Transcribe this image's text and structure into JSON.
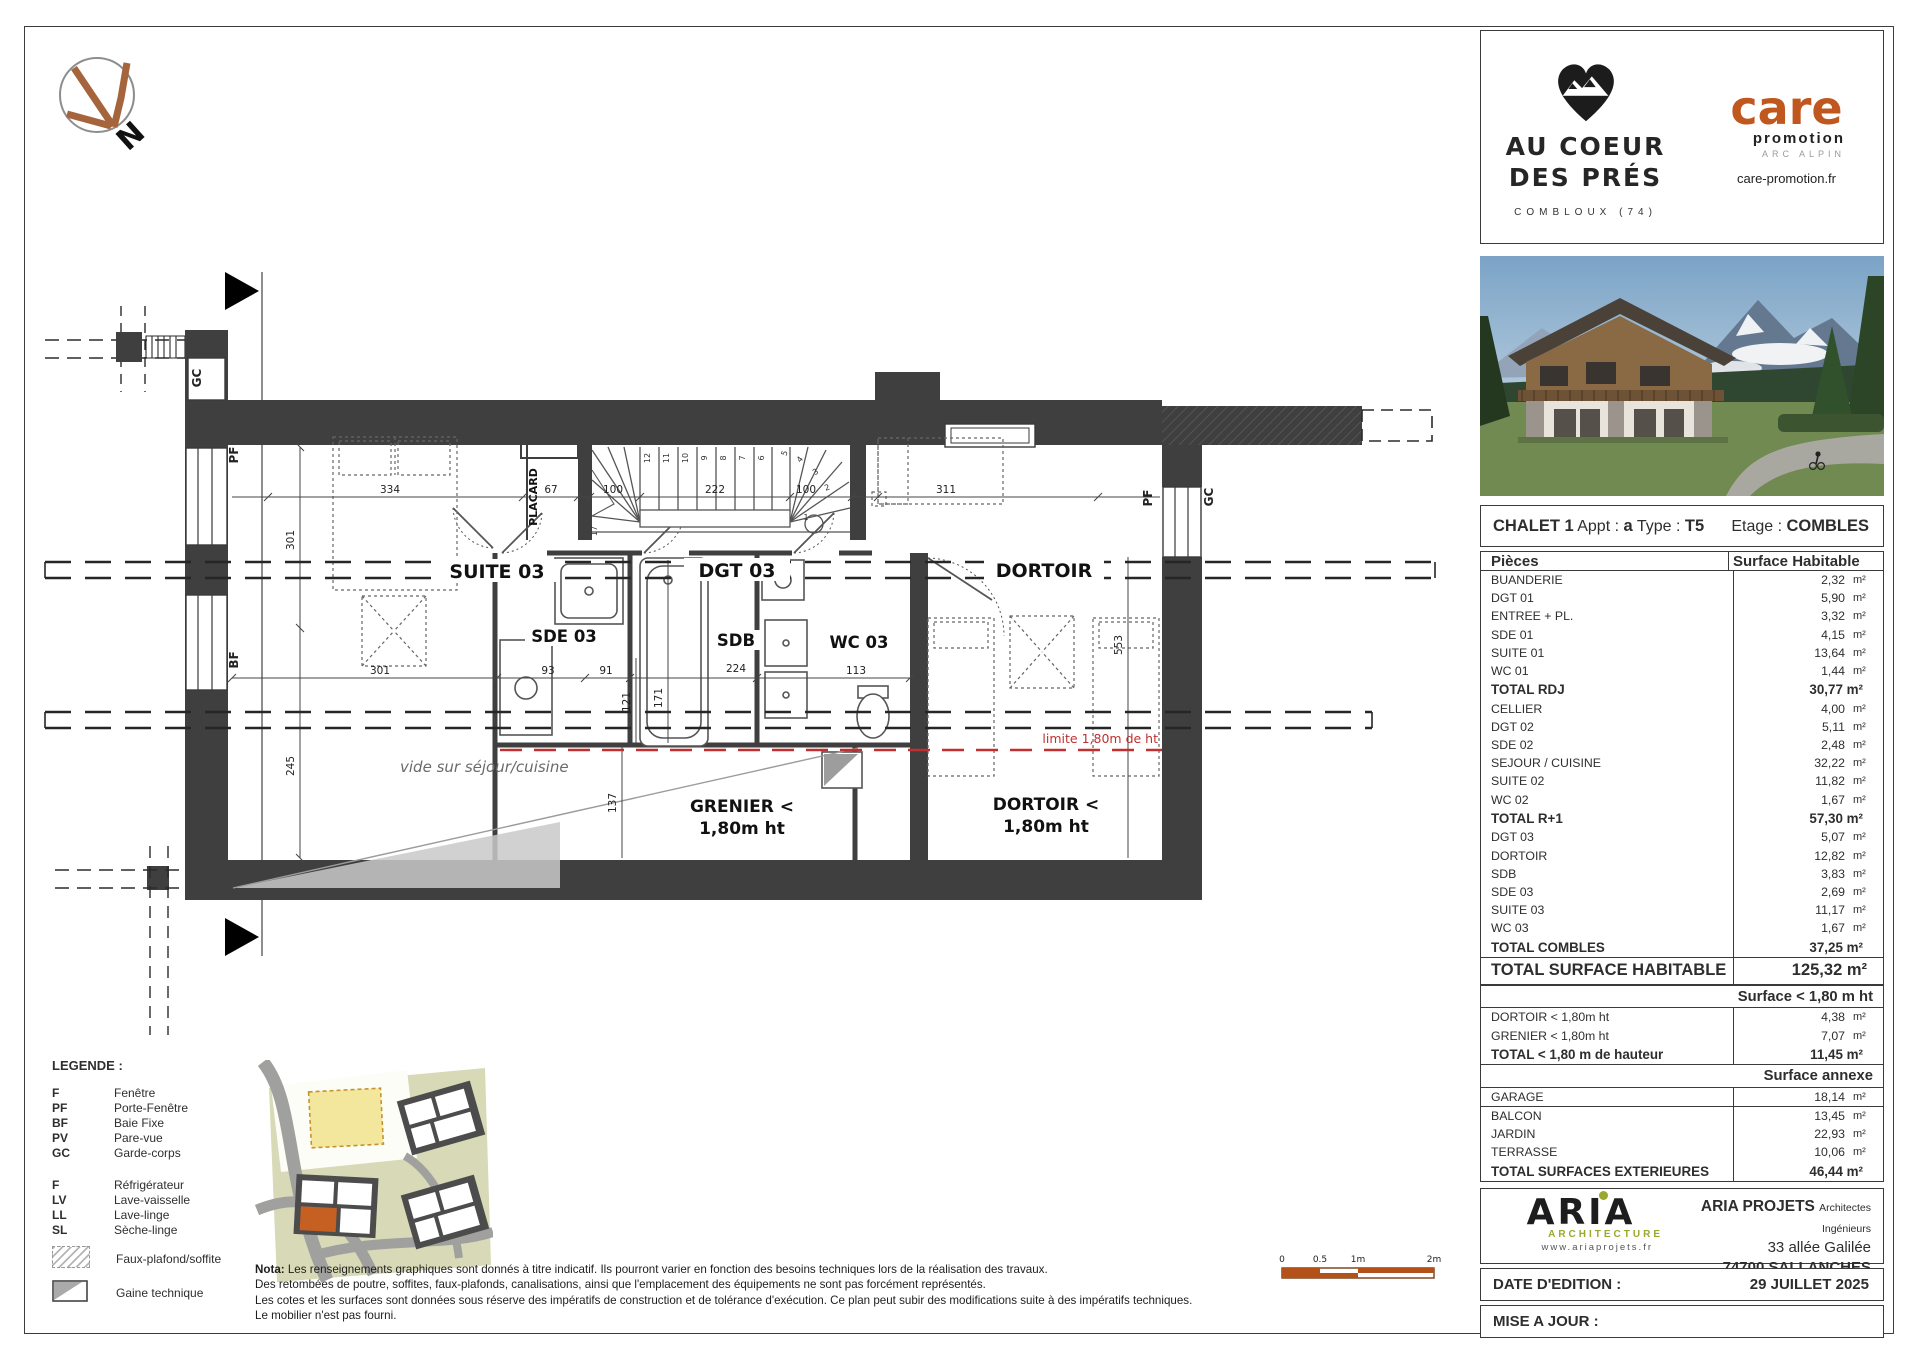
{
  "colors": {
    "accent_orange": "#b5521c",
    "aria_green": "#9aa82e",
    "wall": "#3f3f3f",
    "limit_red": "#c03030"
  },
  "north_label": "N",
  "branding": {
    "project": {
      "line1": "AU COEUR",
      "line2": "DES PRÉS",
      "location": "COMBLOUX (74)"
    },
    "promoter": {
      "name": "care",
      "sub": "promotion",
      "region": "ARC ALPIN",
      "url": "care-promotion.fr"
    }
  },
  "plan": {
    "room_labels": {
      "suite03": "SUITE 03",
      "dgt03": "DGT 03",
      "dortoir": "DORTOIR",
      "sde03": "SDE 03",
      "sdb": "SDB",
      "wc03": "WC 03",
      "placard": "PLACARD"
    },
    "zone_labels": {
      "grenier_l1": "GRENIER <",
      "grenier_l2": "1,80m ht",
      "dortoir_l1": "DORTOIR <",
      "dortoir_l2": "1,80m ht",
      "vide": "vide sur séjour/cuisine",
      "limite": "limite 1,80m de ht"
    },
    "window_labels": {
      "gc_left": "GC",
      "pf_left": "PF",
      "bf_left": "BF",
      "pf_right": "PF",
      "gc_right": "GC"
    },
    "dims": {
      "d334": "334",
      "d67": "67",
      "d100a": "100",
      "d222": "222",
      "d100b": "100",
      "d311": "311",
      "d301v": "301",
      "d245": "245",
      "d301h": "301",
      "d93": "93",
      "d91": "91",
      "d224": "224",
      "d113": "113",
      "d121": "121",
      "d171": "171",
      "d137": "137",
      "d553": "553"
    },
    "stair_numbers": [
      "1",
      "2",
      "3",
      "4",
      "5",
      "6",
      "7",
      "8",
      "9",
      "10",
      "11",
      "12",
      "17"
    ]
  },
  "legend": {
    "title": "LEGENDE :",
    "abbreviations": [
      {
        "abbr": "F",
        "label": "Fenêtre"
      },
      {
        "abbr": "PF",
        "label": "Porte-Fenêtre"
      },
      {
        "abbr": "BF",
        "label": "Baie Fixe"
      },
      {
        "abbr": "PV",
        "label": "Pare-vue"
      },
      {
        "abbr": "GC",
        "label": "Garde-corps"
      }
    ],
    "appliances": [
      {
        "abbr": "F",
        "label": "Réfrigérateur"
      },
      {
        "abbr": "LV",
        "label": "Lave-vaisselle"
      },
      {
        "abbr": "LL",
        "label": "Lave-linge"
      },
      {
        "abbr": "SL",
        "label": "Sèche-linge"
      }
    ],
    "symbols": [
      {
        "label": "Faux-plafond/soffite"
      },
      {
        "label": "Gaine technique"
      }
    ]
  },
  "nota": {
    "prefix": "Nota:",
    "lines": [
      "Les renseignements graphiques sont donnés à titre indicatif. Ils pourront varier en fonction des besoins techniques lors de la réalisation des travaux.",
      "Des retombées de poutre, soffites, faux-plafonds, canalisations, ainsi que l'emplacement des équipements ne sont pas forcément représentés.",
      "Les cotes et les surfaces sont données sous réserve des impératifs de construction et de tolérance d'exécution. Ce plan peut subir des modifications suite à des impératifs techniques.",
      "Le mobilier n'est pas fourni."
    ]
  },
  "scalebar": {
    "ticks": [
      "0",
      "0.5",
      "1m",
      "2m"
    ]
  },
  "title_block": {
    "header": {
      "chalet": "CHALET 1",
      "appt_label": "Appt :",
      "appt_value": "a",
      "type_label": "Type :",
      "type_value": "T5",
      "etage_label": "Etage :",
      "etage_value": "COMBLES"
    },
    "columns": {
      "piece": "Pièces",
      "surface": "Surface Habitable"
    },
    "rows": [
      {
        "cls": "row",
        "label": "BUANDERIE",
        "num": "2,32",
        "unit": "m²"
      },
      {
        "cls": "row",
        "label": "DGT 01",
        "num": "5,90",
        "unit": "m²"
      },
      {
        "cls": "row",
        "label": "ENTREE + PL.",
        "num": "3,32",
        "unit": "m²"
      },
      {
        "cls": "row",
        "label": "SDE 01",
        "num": "4,15",
        "unit": "m²"
      },
      {
        "cls": "row",
        "label": "SUITE 01",
        "num": "13,64",
        "unit": "m²"
      },
      {
        "cls": "row",
        "label": "WC 01",
        "num": "1,44",
        "unit": "m²"
      },
      {
        "cls": "total",
        "label": "TOTAL RDJ",
        "num": "30,77 m²"
      },
      {
        "cls": "row",
        "label": "CELLIER",
        "num": "4,00",
        "unit": "m²"
      },
      {
        "cls": "row",
        "label": "DGT 02",
        "num": "5,11",
        "unit": "m²"
      },
      {
        "cls": "row",
        "label": "SDE 02",
        "num": "2,48",
        "unit": "m²"
      },
      {
        "cls": "row",
        "label": "SEJOUR / CUISINE",
        "num": "32,22",
        "unit": "m²"
      },
      {
        "cls": "row",
        "label": "SUITE 02",
        "num": "11,82",
        "unit": "m²"
      },
      {
        "cls": "row",
        "label": "WC 02",
        "num": "1,67",
        "unit": "m²"
      },
      {
        "cls": "total",
        "label": "TOTAL R+1",
        "num": "57,30 m²"
      },
      {
        "cls": "row",
        "label": "DGT 03",
        "num": "5,07",
        "unit": "m²"
      },
      {
        "cls": "row",
        "label": "DORTOIR",
        "num": "12,82",
        "unit": "m²"
      },
      {
        "cls": "row",
        "label": "SDB",
        "num": "3,83",
        "unit": "m²"
      },
      {
        "cls": "row",
        "label": "SDE 03",
        "num": "2,69",
        "unit": "m²"
      },
      {
        "cls": "row",
        "label": "SUITE 03",
        "num": "11,17",
        "unit": "m²"
      },
      {
        "cls": "row",
        "label": "WC 03",
        "num": "1,67",
        "unit": "m²"
      },
      {
        "cls": "total",
        "label": "TOTAL COMBLES",
        "num": "37,25 m²"
      },
      {
        "cls": "grand",
        "label": "TOTAL SURFACE HABITABLE",
        "num": "125,32 m²"
      },
      {
        "cls": "section",
        "label": "Surface < 1,80 m ht"
      },
      {
        "cls": "row",
        "label": "DORTOIR < 1,80m ht",
        "num": "4,38",
        "unit": "m²"
      },
      {
        "cls": "row",
        "label": "GRENIER < 1,80m ht",
        "num": "7,07",
        "unit": "m²"
      },
      {
        "cls": "total",
        "label": "TOTAL < 1,80 m de hauteur",
        "num": "11,45 m²"
      },
      {
        "cls": "section",
        "label": "Surface annexe"
      },
      {
        "cls": "row bb",
        "label": "GARAGE",
        "num": "18,14",
        "unit": "m²"
      },
      {
        "cls": "row",
        "label": "BALCON",
        "num": "13,45",
        "unit": "m²"
      },
      {
        "cls": "row",
        "label": "JARDIN",
        "num": "22,93",
        "unit": "m²"
      },
      {
        "cls": "row",
        "label": "TERRASSE",
        "num": "10,06",
        "unit": "m²"
      },
      {
        "cls": "total",
        "label": "TOTAL SURFACES EXTERIEURES",
        "num": "46,44 m²"
      }
    ]
  },
  "architect": {
    "logo_text": "ARIA",
    "logo_sub": "ARCHITECTURE",
    "logo_url": "www.ariaprojets.fr",
    "firm": "ARIA PROJETS",
    "firm_sub": "Architectes Ingénieurs",
    "address1": "33 allée Galilée",
    "address2": "74700 SALLANCHES"
  },
  "dates": {
    "edition_label": "DATE D'EDITION :",
    "edition_value": "29 JUILLET 2025",
    "maj_label": "MISE A JOUR :",
    "maj_value": ""
  }
}
